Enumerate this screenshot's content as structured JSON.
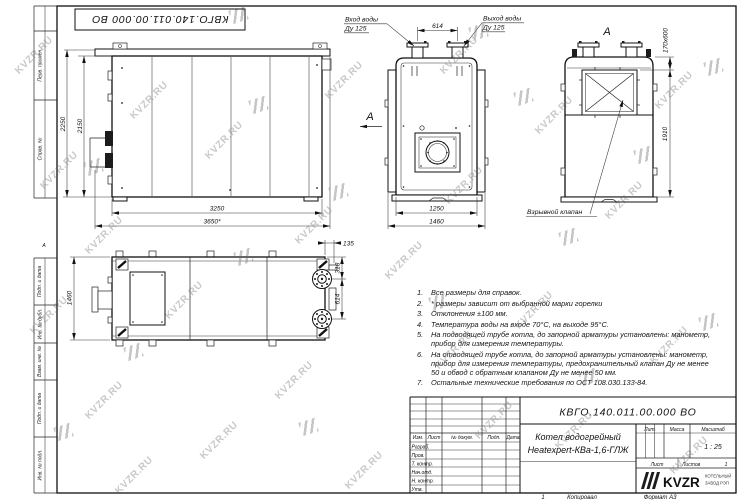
{
  "watermark": {
    "text": "KVZR.RU"
  },
  "border": {
    "designation_top": "КВГО.140.011.00.000 ВО",
    "strip_top": [
      "Перв. примен.",
      "Справ. №"
    ],
    "strip_bottom": [
      "Подп. и дата",
      "Инв. № дубл.",
      "Взам. инв. №",
      "Подп. и дата",
      "Инв. № подл."
    ],
    "zone_marker": "А"
  },
  "drawing": {
    "side_view": {
      "dim_height_outer": "2250",
      "dim_height_body": "2150",
      "dim_length_body": "3250",
      "dim_length_total": "3650*"
    },
    "front_view": {
      "dim_pipe_spacing": "614",
      "dim_width_body": "1250",
      "dim_width_total": "1460",
      "inlet_label": "Вход воды",
      "inlet_dn": "Ду 125",
      "outlet_label": "Выход воды",
      "outlet_dn": "Ду 125",
      "section_arrow": "А"
    },
    "rear_view": {
      "view_label": "А",
      "dim_flue": "170х600",
      "dim_height": "1910",
      "callout_explosion_valve": "Взрывной клапан"
    },
    "plan_view": {
      "dim_width": "1460",
      "dim_edge_offset": "135",
      "dim_pipe_offset": "318",
      "dim_pipe_spacing": "614"
    }
  },
  "notes": {
    "items": [
      {
        "num": "1.",
        "text": "Все размеры для справок."
      },
      {
        "num": "2.",
        "text": "* размеры зависит от выбранной марки горелки"
      },
      {
        "num": "3.",
        "text": "Отклонения ±100 мм."
      },
      {
        "num": "4.",
        "text": "Температура воды на входе 70°С, на выходе 95°С."
      },
      {
        "num": "5.",
        "text": "На подводящей трубе котла, до запорной арматуры установлены: манометр, прибор для измерения температуры."
      },
      {
        "num": "6.",
        "text": "На отводящей трубе котла, до запорной арматуры установлены: манометр, прибор для измерения температуры, предохранительный клапан Ду не менее 50 и обвод с обратным клапаном Ду не менее 50 мм."
      },
      {
        "num": "7.",
        "text": "Остальные технические требования по ОСТ 108.030.133-84."
      }
    ]
  },
  "title_block": {
    "designation": "КВГО.140.011.00.000 ВО",
    "product_name_line1": "Котел водогрейный",
    "product_name_line2": "Heatexpert-КВа-1,6-ГЛЖ",
    "cols": {
      "izm": "Изм.",
      "list": "Лист",
      "doc": "№ докум.",
      "sign": "Подп.",
      "date": "Дата"
    },
    "rows": [
      "Разраб.",
      "Пров.",
      "Т. контр.",
      "Нач.отд.",
      "Н. контр.",
      "Утв."
    ],
    "lit_label": "Лит.",
    "mass_label": "Масса",
    "scale_label": "Масштаб",
    "scale_value": "1 : 25",
    "sheet_label": "Лист",
    "sheets_label": "Листов",
    "sheets_value": "1",
    "company_logo": "KVZR",
    "company_line1": "КОТЕЛЬНЫЙ",
    "company_line2": "ЗАВОД РЭП",
    "copy_num": "1",
    "copied_label": "Копировал",
    "format_label": "Формат А3"
  }
}
